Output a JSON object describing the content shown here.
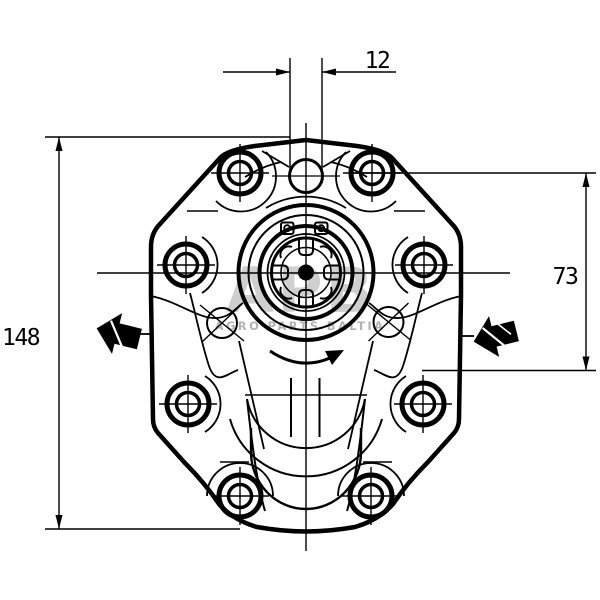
{
  "drawing": {
    "dimensions": {
      "top_width": "12",
      "right_height": "73",
      "left_height": "148"
    },
    "watermark": {
      "logo": "APB",
      "name": "AGRO PARTS BALTIA"
    },
    "colors": {
      "line": "#000000",
      "background": "#ffffff",
      "watermark_gray": "#a0a0a0",
      "port_arrow_fill": "#000000"
    }
  }
}
